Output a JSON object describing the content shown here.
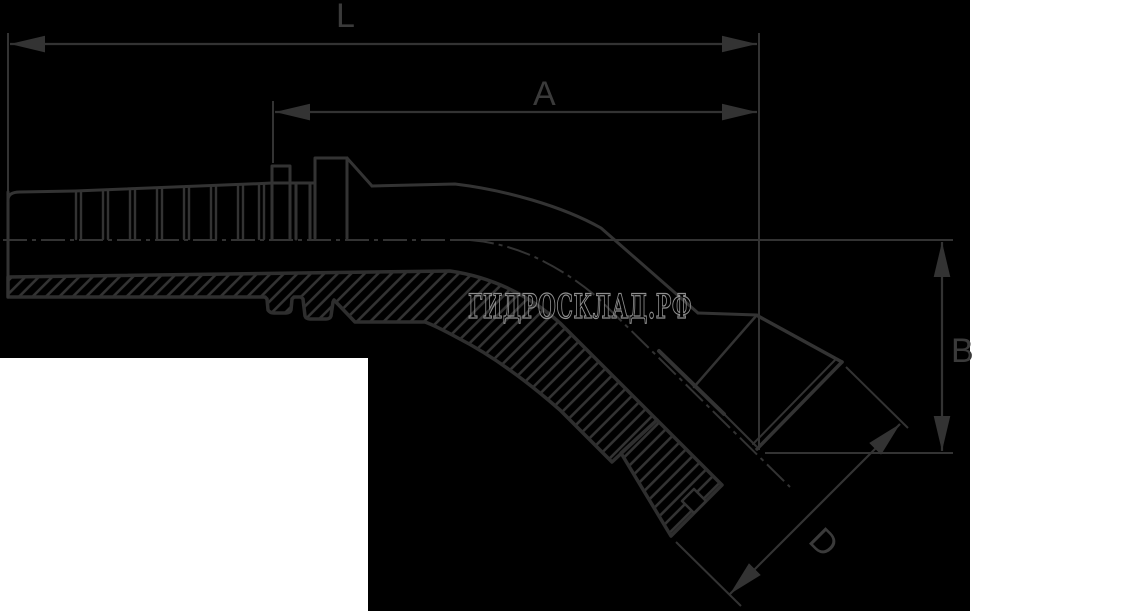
{
  "drawing": {
    "title_hint": "45-degree flange hose fitting section drawing",
    "dimension_labels": {
      "top_overall": "L",
      "top_inner": "A",
      "right_vertical": "B",
      "diagonal_flange": "D"
    },
    "watermark": "ГИДРОСКЛАД.РФ",
    "colors": {
      "background": "#000000",
      "panel": "#ffffff",
      "line": "#333333",
      "heavy_line": "#2e2e2e",
      "label": "#3a3a3a",
      "watermark_stroke": "#8f8f8f"
    }
  }
}
